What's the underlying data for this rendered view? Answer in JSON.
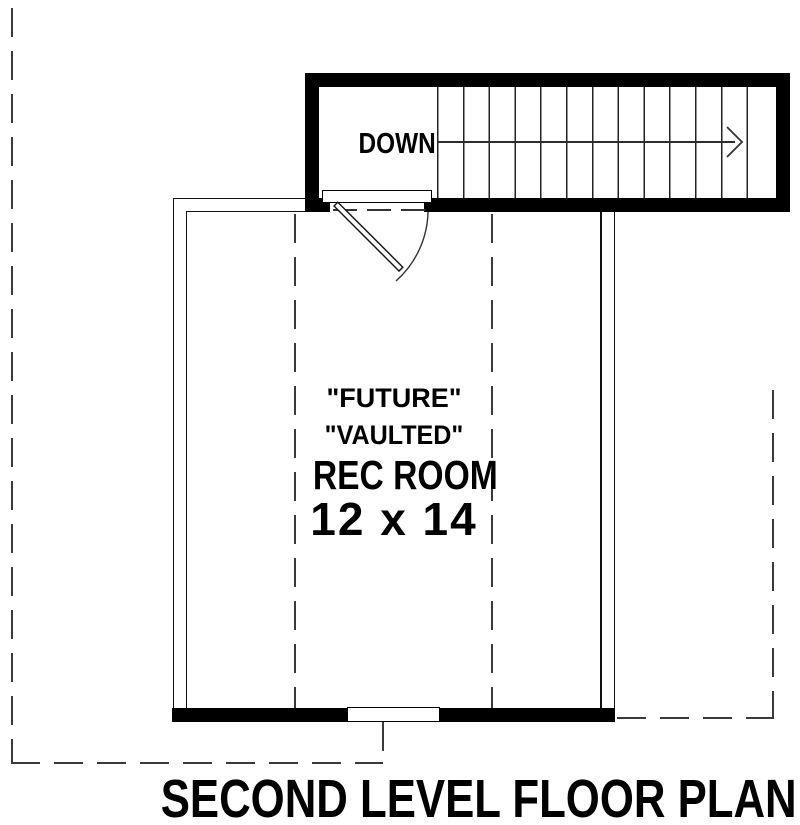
{
  "plan": {
    "title": "SECOND LEVEL FLOOR PLAN",
    "stairs": {
      "direction_label": "DOWN",
      "tread_count": 13,
      "arrow_direction": "right"
    },
    "room": {
      "label_line1": "\"FUTURE\"",
      "label_line2": "\"VAULTED\"",
      "label_line3": "REC ROOM",
      "label_line4": "12 x 14"
    },
    "colors": {
      "wall": "#000000",
      "background": "#ffffff",
      "thin_line": "#333333"
    }
  }
}
